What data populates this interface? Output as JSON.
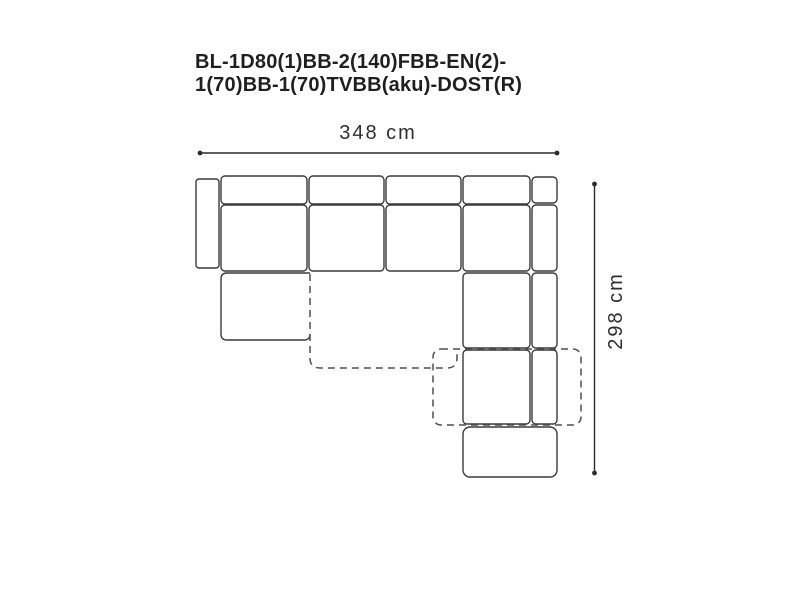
{
  "title": {
    "line1": "BL-1D80(1)BB-2(140)FBB-EN(2)-",
    "line2": "1(70)BB-1(70)TVBB(aku)-DOST(R)"
  },
  "dimensions": {
    "width_label": "348 cm",
    "height_label": "298 cm",
    "width_value_cm": 348,
    "height_value_cm": 298
  },
  "colors": {
    "background": "#ffffff",
    "outline": "#3a3a3a",
    "dashed_outline": "#4f4f4f",
    "dimension_line": "#2b2b2b",
    "title_text": "#1f1f1f",
    "dimension_text": "#2e2e2e"
  },
  "diagram": {
    "type": "sofa-top-view-dimension-drawing",
    "modules": [
      "left-armrest",
      "seat-module-1",
      "seat-module-2",
      "seat-module-3",
      "corner-module",
      "right-backrest-strip",
      "right-seat-module-1",
      "right-seat-module-2",
      "chaise-module",
      "ottoman-module",
      "pull-out-extension-dashed"
    ]
  }
}
